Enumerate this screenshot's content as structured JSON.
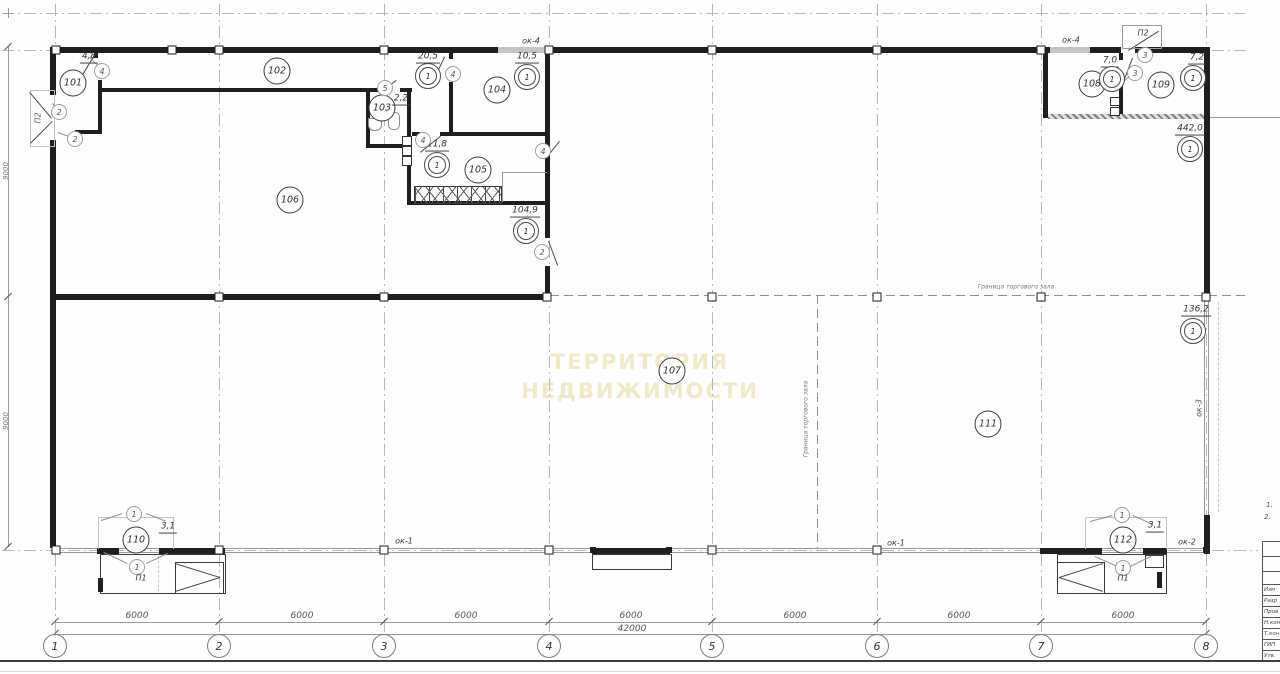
{
  "watermark": {
    "line1": "ТЕРРИТОРИЯ",
    "line2": "НЕДВИЖИМОСТИ"
  },
  "rooms": {
    "r101": {
      "number": "101",
      "area": "4,8"
    },
    "r102": {
      "number": "102",
      "area": "20,5",
      "ref": "1"
    },
    "r103": {
      "number": "103",
      "area": "2,2"
    },
    "r104": {
      "number": "104",
      "area": "10,5",
      "ref": "1"
    },
    "r105": {
      "number": "105",
      "area": "11,8",
      "ref": "1"
    },
    "r106": {
      "number": "106",
      "area": "104,9",
      "ref": "1"
    },
    "r107": {
      "number": "107",
      "area": "442,0",
      "ref": "1"
    },
    "r108": {
      "number": "108",
      "area": "7,0",
      "ref": "1"
    },
    "r109": {
      "number": "109",
      "area": "7,2",
      "ref": "1"
    },
    "r110": {
      "number": "110",
      "area": "3,1"
    },
    "r111": {
      "number": "111",
      "area": "136,2",
      "ref": "1"
    },
    "r112": {
      "number": "112",
      "area": "3,1"
    }
  },
  "door_marks": {
    "m1": "1",
    "m2": "2",
    "m3": "3",
    "m4": "4",
    "m5": "5"
  },
  "windows": {
    "ok1": "ок-1",
    "ok2": "ок-2",
    "ok3": "ок-3",
    "ok4": "ок-4"
  },
  "vestibules": {
    "p1": "П1",
    "p2": "П2"
  },
  "boundary": {
    "label": "Граница торгового зала"
  },
  "grid": {
    "axes": [
      "1",
      "2",
      "3",
      "4",
      "5",
      "6",
      "7",
      "8"
    ],
    "bay": "6000",
    "total": "42000",
    "depth": "9000"
  },
  "notes": [
    "1.",
    "2."
  ],
  "title_block": {
    "rows": [
      "Изм",
      "Разр",
      "Пров",
      "Н.кон",
      "Т.кон",
      "ГИП",
      "Утв."
    ]
  }
}
